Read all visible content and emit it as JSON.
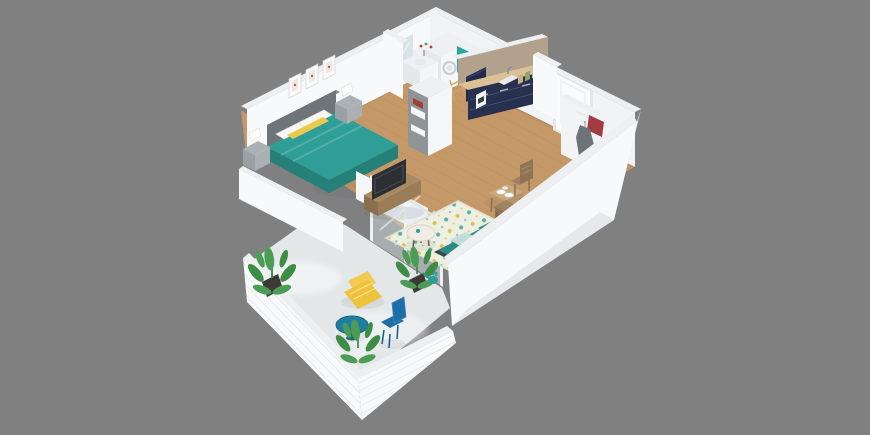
{
  "scene": {
    "description": "Isometric 3D rendered floor plan of a one-bedroom apartment with balcony on a gray background",
    "view": "isometric-cutaway",
    "background": "#808080"
  },
  "colors": {
    "background": "#808080",
    "wallBright": "#f8f9fa",
    "wallFace": "#f1f3f5",
    "wallShade": "#e4e8eb",
    "wallCap": "#edeff1",
    "floorWood": "#c59868",
    "floorWoodLine": "#a97f4d",
    "bathFloor": "#eef1f1",
    "balconyFloor": "#e3e7e8",
    "bedTeal": "#2f9e96",
    "bedTealDark": "#258078",
    "headboard": "#6f7478",
    "pillowWhite": "#f7f7f5",
    "pillowYellow": "#e9c94e",
    "nightstand": "#9aa0a4",
    "nightstandLight": "#aab0b4",
    "lamp": "#fdfdfc",
    "sofaDark": "#3f444a",
    "sofaLight": "#4a5057",
    "cushionYellow": "#d8b945",
    "cushionTeal": "#2a8c85",
    "throwLight": "#bfded9",
    "rugBase": "#edefe0",
    "rugTeal": "#57b0a8",
    "rugYellow": "#dfc257",
    "woodFurniture": "#9a7c58",
    "woodFurnitureDark": "#8a6f4e",
    "tableWood": "#c8a97e",
    "tableWoodDark": "#b2936a",
    "tvDark": "#2c2f33",
    "kitchenNavy": "#28304f",
    "kitchenNavyDark": "#222a47",
    "counterWood": "#dcc096",
    "backsplashTan": "#b2a18d",
    "fridgeWhite": "#f4f6f8",
    "applianceWhite": "#eef0f1",
    "tealAccent": "#28a79e",
    "mirror": "#d9e4e8",
    "doorWhite": "#fafbfc",
    "doorFrame": "#e3e5e7",
    "coatGray": "#6d7377",
    "bagRed": "#a23c43",
    "loungerYellow": "#efc23b",
    "loungerYellowLight": "#f2ca52",
    "bistroBlue": "#1f7fa2",
    "chairBlue": "#1d6ea6",
    "plantGreen": "#4c9c55",
    "plantGreenDark": "#3e8c46",
    "potDark": "#3d3a36"
  },
  "rooms": [
    {
      "name": "bedroom",
      "furniture": [
        "double-bed-teal",
        "headboard",
        "nightstand-left",
        "nightstand-right",
        "table-lamps",
        "wall-frames"
      ]
    },
    {
      "name": "bathroom",
      "furniture": [
        "vanity-sink",
        "mirror",
        "washing-machine",
        "teal-shower-wall"
      ]
    },
    {
      "name": "kitchen",
      "furniture": [
        "navy-l-counter",
        "upper-cabinet",
        "sink",
        "coffee-maker",
        "jars",
        "tall-fridge-cabinet",
        "tan-backsplash"
      ]
    },
    {
      "name": "living-dining",
      "furniture": [
        "tv-bench",
        "tv",
        "patterned-rug",
        "dark-sofa",
        "round-side-table",
        "dining-table",
        "dining-chairs",
        "plants"
      ]
    },
    {
      "name": "entry",
      "furniture": [
        "front-door",
        "coat-rack",
        "red-bag",
        "shelf"
      ]
    },
    {
      "name": "balcony",
      "furniture": [
        "yellow-lounger",
        "blue-bistro-table",
        "blue-chair",
        "potted-plants",
        "glass-railing"
      ]
    }
  ]
}
